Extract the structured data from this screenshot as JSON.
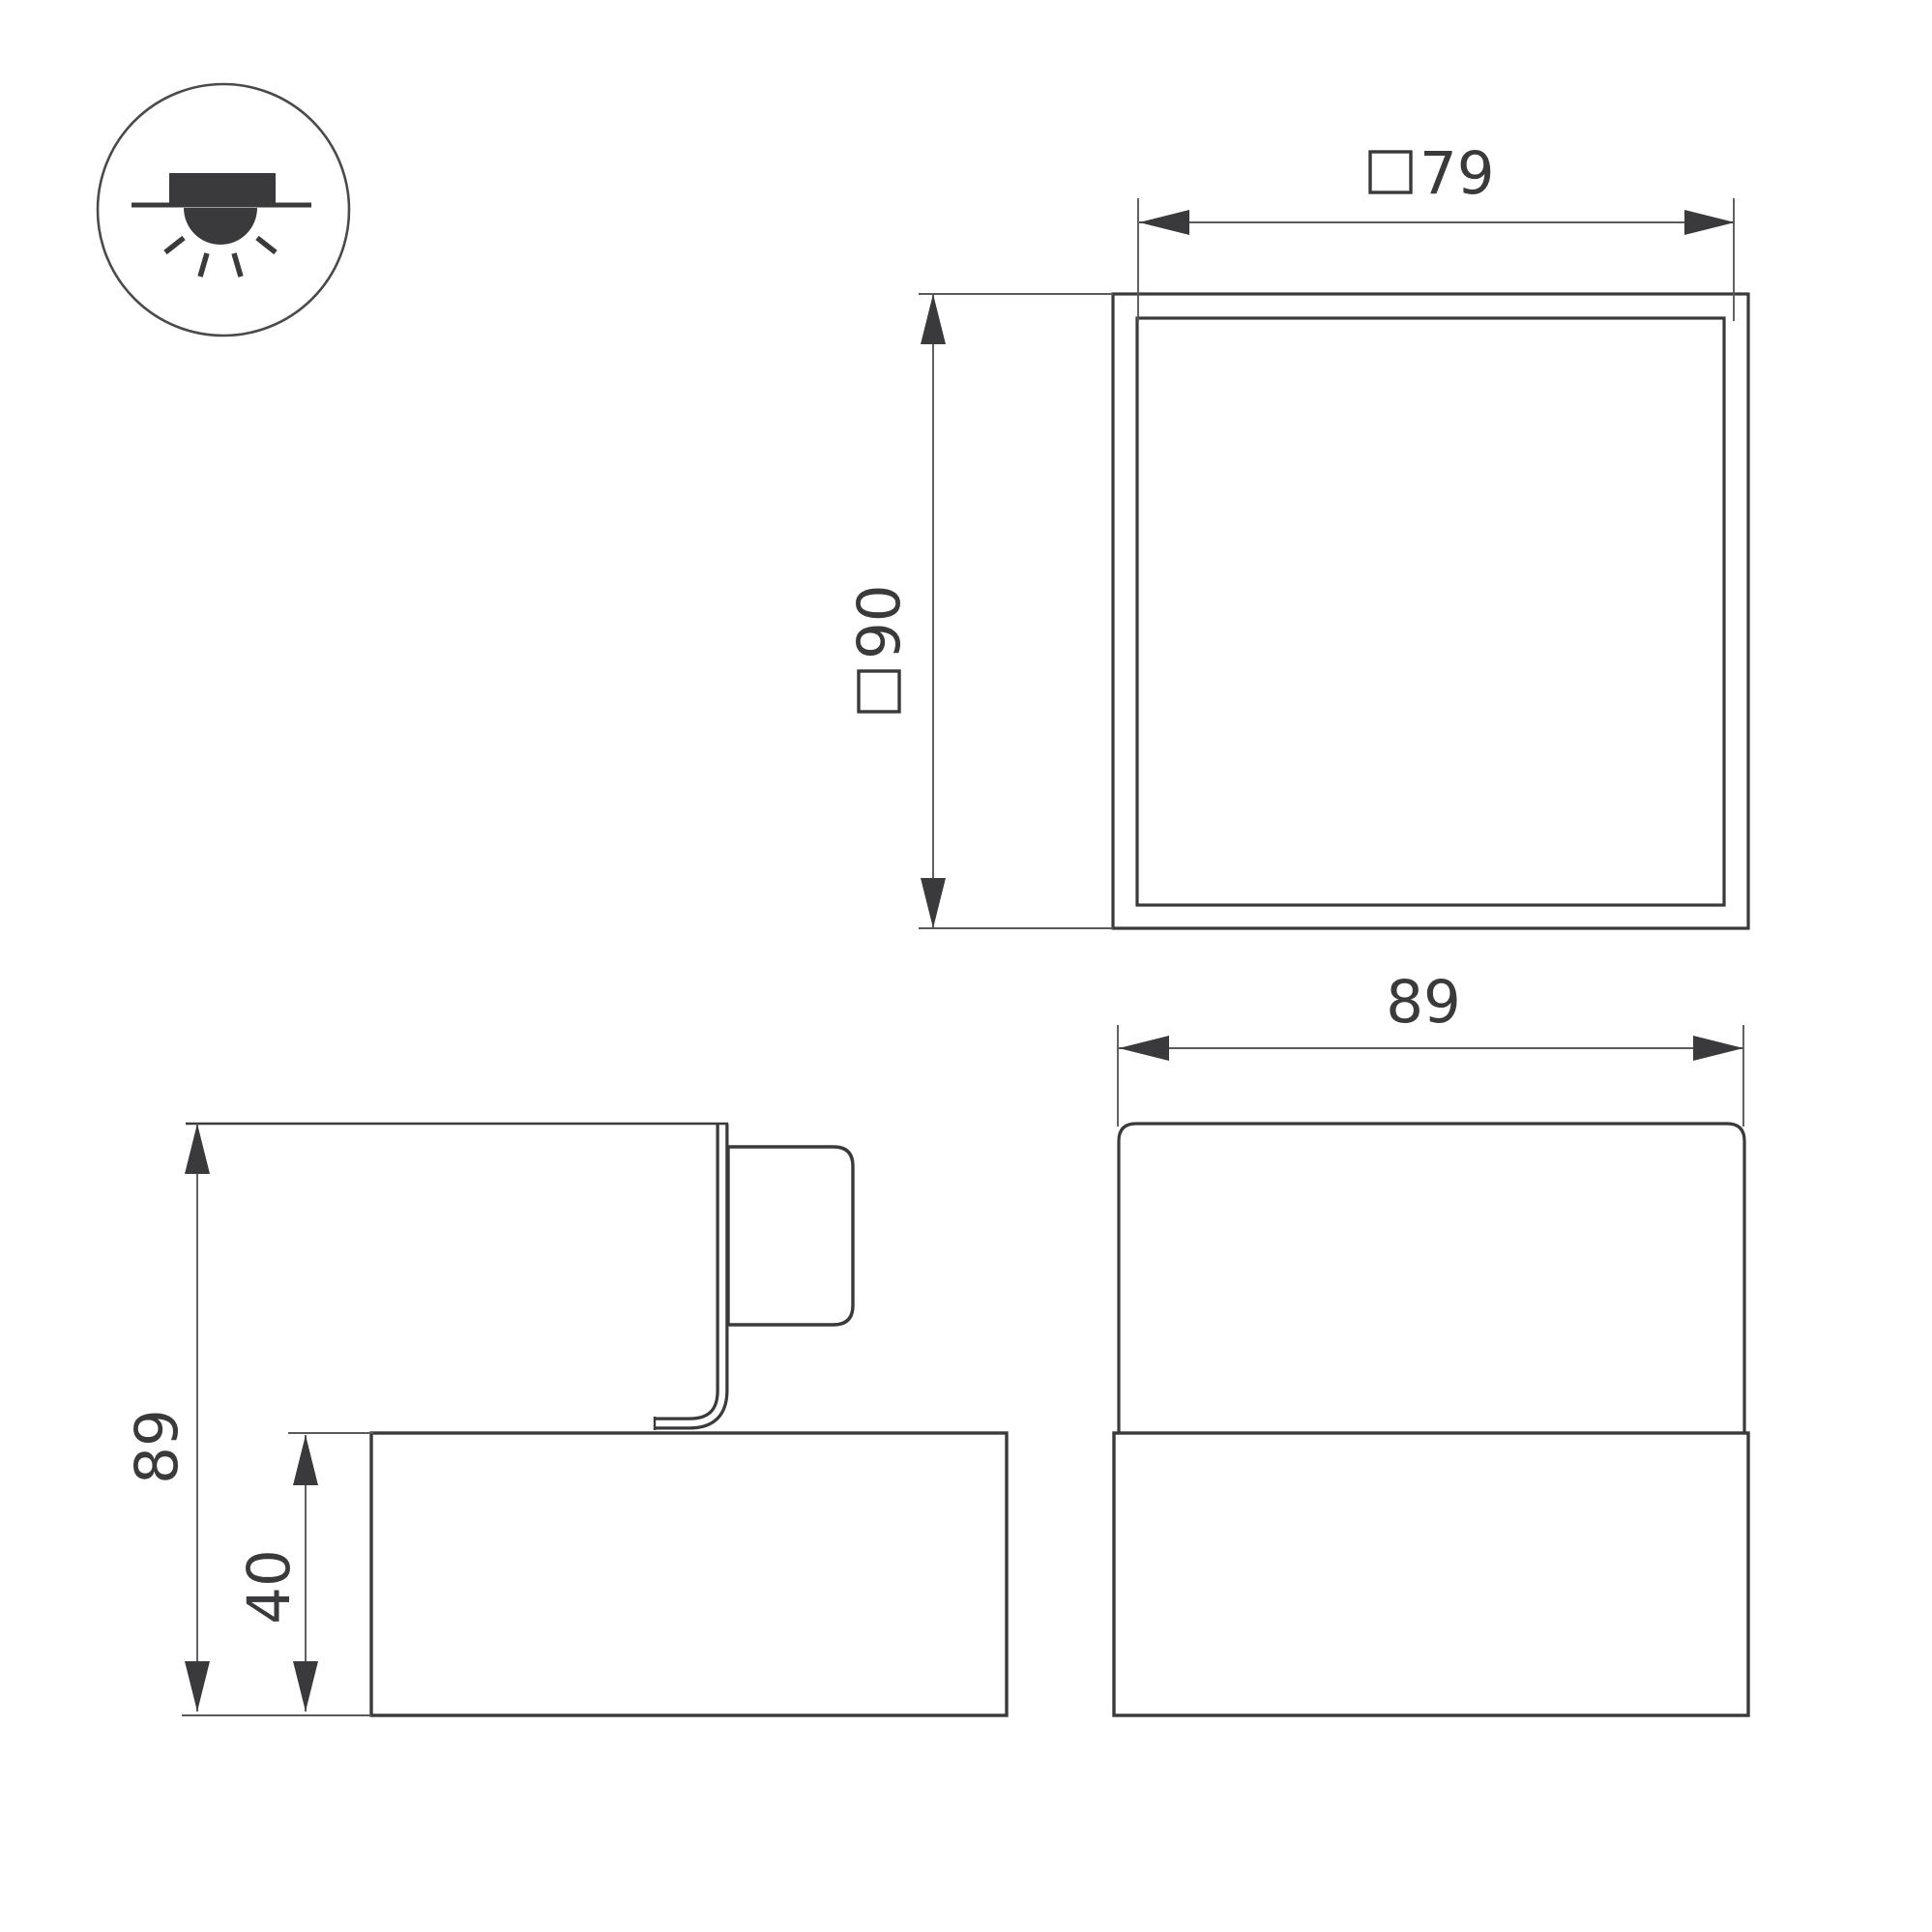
{
  "title": "Luminaire dimension drawing",
  "colors": {
    "background": "#ffffff",
    "object_line": "#3a3a3c",
    "thin_line": "#5a5a5c",
    "text": "#3a3a3c"
  },
  "icon": {
    "name": "recessed-downlight-icon",
    "meaning": "recessed mounting with light emitting downwards"
  },
  "views": {
    "top": {
      "name": "top view",
      "dims": [
        {
          "prefix": "□",
          "value": "79",
          "orientation": "horizontal"
        },
        {
          "prefix": "□",
          "value": "90",
          "orientation": "vertical"
        }
      ]
    },
    "side": {
      "name": "side view",
      "dims": [
        {
          "value": "89",
          "orientation": "vertical"
        },
        {
          "value": "40",
          "orientation": "vertical"
        }
      ]
    },
    "front": {
      "name": "front view",
      "dims": [
        {
          "value": "89",
          "orientation": "horizontal"
        }
      ]
    }
  }
}
